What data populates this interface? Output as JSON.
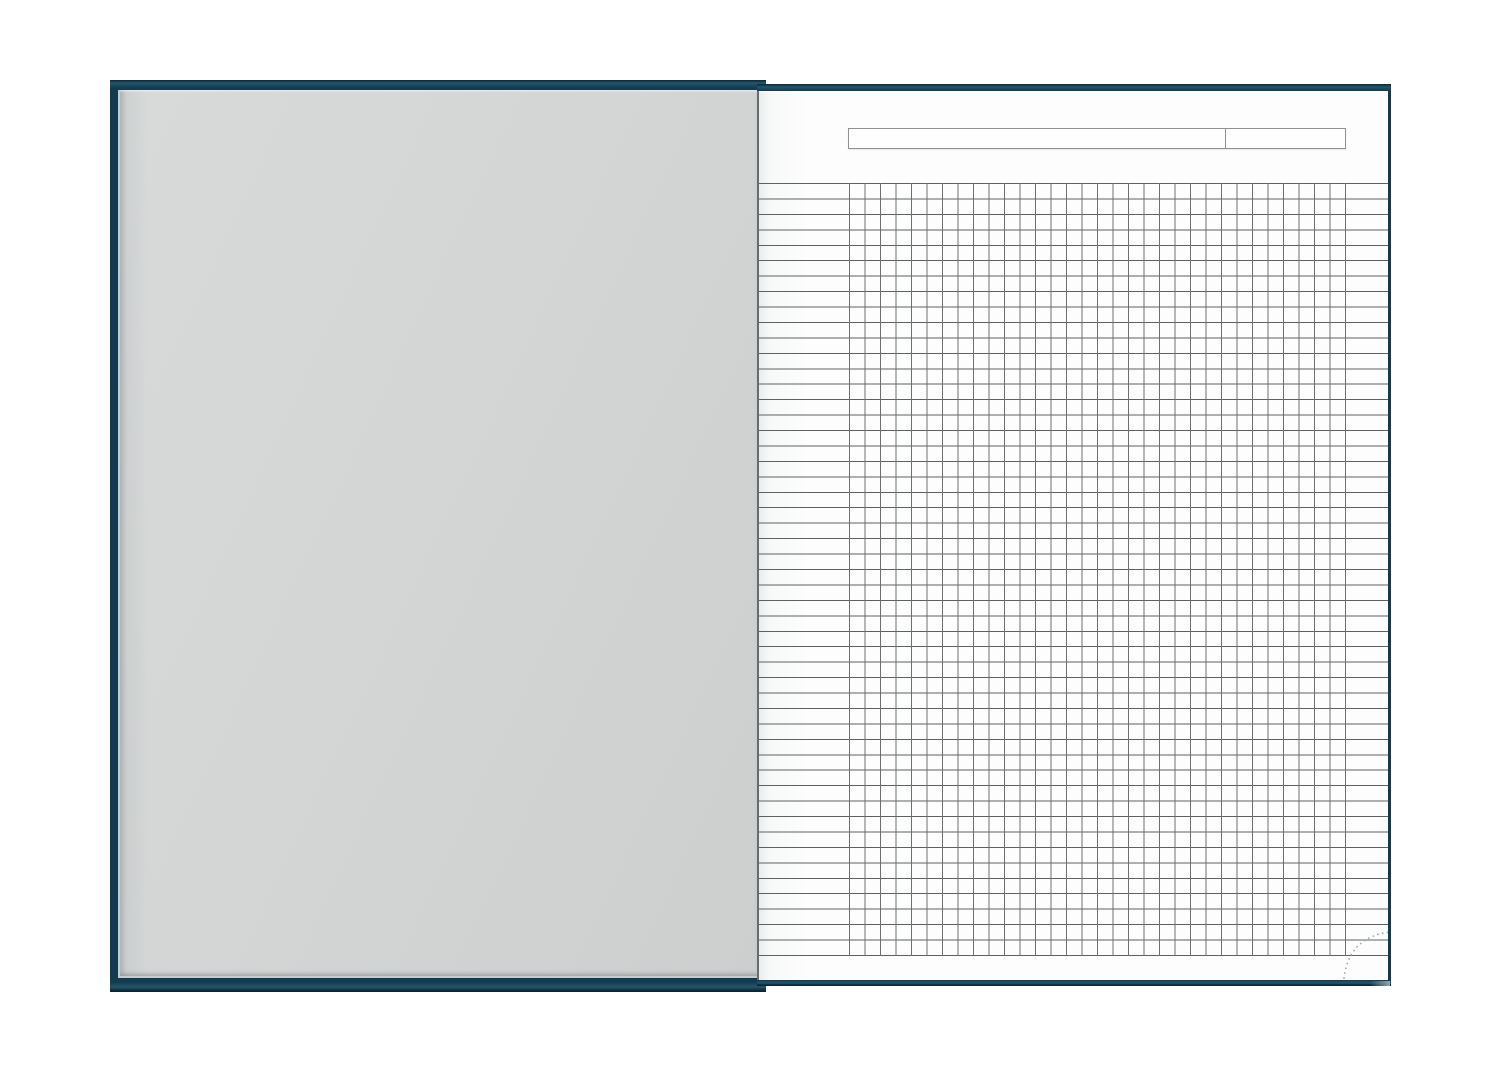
{
  "background_color": "#ffffff",
  "colors": {
    "bg": "#ffffff",
    "cover_base": "#133a4e",
    "cover_dark": "#0c2534",
    "cover_teal": "#265569",
    "endpaper": "#d4d6d6",
    "endpaper_edge": "#c3cdd1",
    "paper": "#fdfdfd",
    "paper_gutter_shade": "#ebeded",
    "gutter_line": "#666d70",
    "rule_h": "#5d6164",
    "rule_v": "#6c7073",
    "field_border": "#8f9193",
    "curl_dot": "#a2a7aa",
    "corner_sheen": "#8fa6af"
  },
  "notebook": {
    "state": "open-flat",
    "left_page": {
      "type": "blank-grey-endpaper",
      "text": ""
    },
    "right_page": {
      "type": "squared-notebook-sheet",
      "header": {
        "main_field_value": "",
        "side_field_value": ""
      },
      "grid": {
        "columns": 32,
        "rows": 50,
        "cell_width_px": 15.5,
        "cell_height_px": 15.44,
        "ruled_left_margin": true,
        "ruled_right_margin": true
      },
      "corner_fold": {
        "style": "dotted-arc",
        "position": "bottom-right"
      }
    }
  }
}
